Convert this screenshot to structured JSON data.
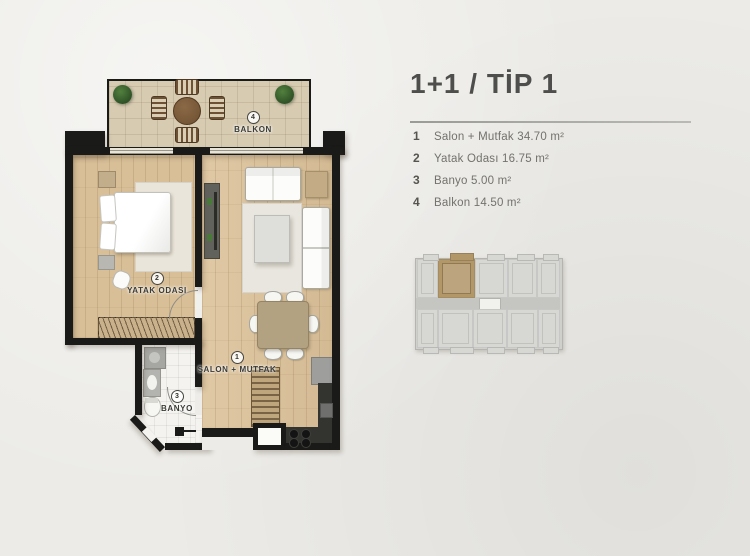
{
  "header": {
    "title": "1+1 / TİP 1"
  },
  "legend": {
    "items": [
      {
        "num": "1",
        "text": "Salon + Mutfak 34.70 m²"
      },
      {
        "num": "2",
        "text": "Yatak Odası 16.75 m²"
      },
      {
        "num": "3",
        "text": "Banyo 5.00 m²"
      },
      {
        "num": "4",
        "text": "Balkon 14.50 m²"
      }
    ]
  },
  "plan_labels": {
    "salon": {
      "num": "1",
      "name": "SALON + MUTFAK"
    },
    "bedroom": {
      "num": "2",
      "name": "YATAK ODASI"
    },
    "bathroom": {
      "num": "3",
      "name": "BANYO"
    },
    "balcony": {
      "num": "4",
      "name": "BALKON"
    }
  },
  "colors": {
    "background": "#ecebe7",
    "wall": "#1a1a18",
    "wood_salon": "#dcc29a",
    "wood_bedroom": "#d8bf98",
    "balcony_tile": "#d7cbb2",
    "bath_tile": "#f4f3f0",
    "title_text": "#4e4e4c",
    "legend_text": "#73726c",
    "divider_line": "#9a9a96",
    "minimap_unit": "#d7d7d4",
    "minimap_highlight": "#b29769"
  },
  "minimap": {
    "units": [
      {
        "x": 2,
        "y": 6,
        "w": 21,
        "h": 39,
        "hl": false
      },
      {
        "x": 23,
        "y": 6,
        "w": 37,
        "h": 39,
        "hl": true
      },
      {
        "x": 60,
        "y": 6,
        "w": 33,
        "h": 39,
        "hl": false
      },
      {
        "x": 93,
        "y": 6,
        "w": 29,
        "h": 39,
        "hl": false
      },
      {
        "x": 122,
        "y": 6,
        "w": 23,
        "h": 39,
        "hl": false
      },
      {
        "x": 2,
        "y": 56,
        "w": 21,
        "h": 39,
        "hl": false
      },
      {
        "x": 23,
        "y": 56,
        "w": 35,
        "h": 39,
        "hl": false
      },
      {
        "x": 58,
        "y": 56,
        "w": 34,
        "h": 39,
        "hl": false
      },
      {
        "x": 92,
        "y": 56,
        "w": 31,
        "h": 39,
        "hl": false
      },
      {
        "x": 123,
        "y": 56,
        "w": 22,
        "h": 39,
        "hl": false
      }
    ],
    "tabs": [
      {
        "x": 8,
        "y": 1,
        "w": 14,
        "h": 5,
        "hl": false
      },
      {
        "x": 35,
        "y": 0,
        "w": 22,
        "h": 6,
        "hl": true
      },
      {
        "x": 72,
        "y": 1,
        "w": 16,
        "h": 5,
        "hl": false
      },
      {
        "x": 102,
        "y": 1,
        "w": 16,
        "h": 5,
        "hl": false
      },
      {
        "x": 128,
        "y": 1,
        "w": 14,
        "h": 5,
        "hl": false
      },
      {
        "x": 8,
        "y": 94,
        "w": 14,
        "h": 5,
        "hl": false
      },
      {
        "x": 35,
        "y": 94,
        "w": 22,
        "h": 5,
        "hl": false
      },
      {
        "x": 72,
        "y": 94,
        "w": 16,
        "h": 5,
        "hl": false
      },
      {
        "x": 102,
        "y": 94,
        "w": 16,
        "h": 5,
        "hl": false
      },
      {
        "x": 128,
        "y": 94,
        "w": 14,
        "h": 5,
        "hl": false
      }
    ]
  }
}
